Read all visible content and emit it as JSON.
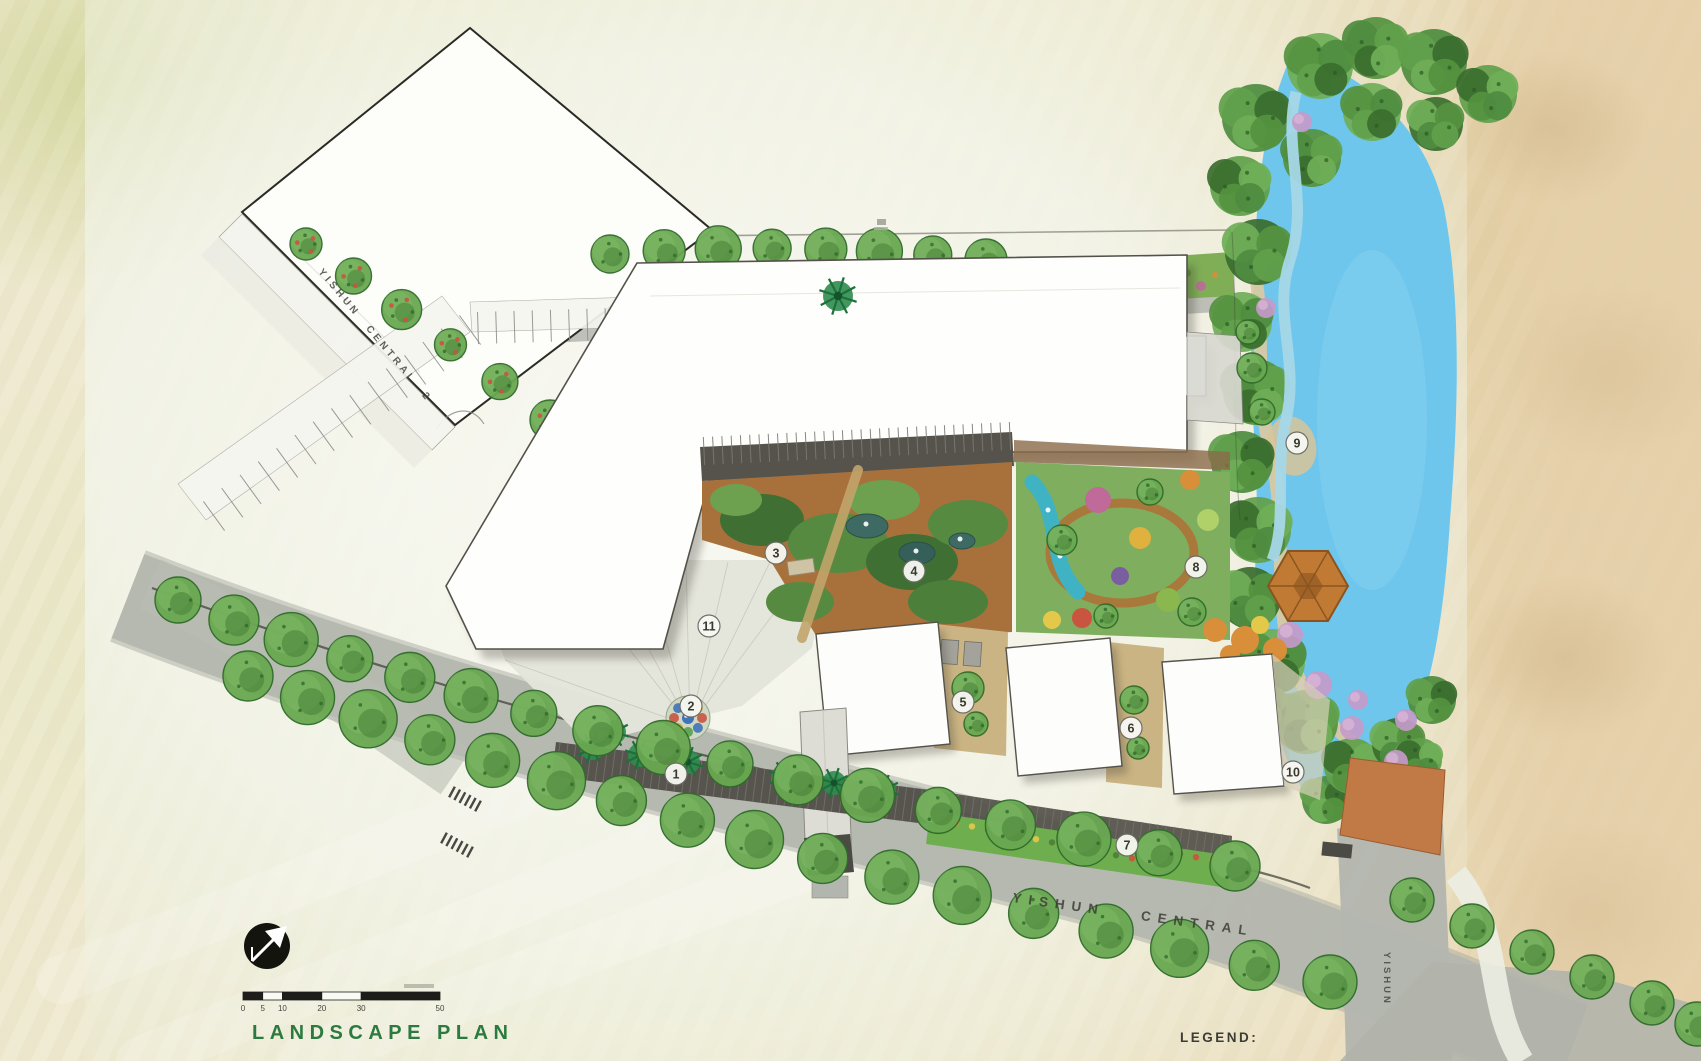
{
  "plan": {
    "title": "LANDSCAPE PLAN",
    "legend_label": "LEGEND:",
    "streets": [
      {
        "name": "YISHUN CENTRAL 2",
        "x": 318,
        "y": 272,
        "rotate": 50,
        "style": "st1"
      },
      {
        "name": "YISHUN CENTRAL",
        "x": 1012,
        "y": 902,
        "rotate": 8,
        "style": "st2"
      },
      {
        "name": "YISHUN",
        "x": 1384,
        "y": 952,
        "rotate": 90,
        "style": "st3"
      }
    ],
    "markers": [
      {
        "label": "1",
        "x": 676,
        "y": 774
      },
      {
        "label": "2",
        "x": 691,
        "y": 706
      },
      {
        "label": "3",
        "x": 776,
        "y": 553
      },
      {
        "label": "4",
        "x": 914,
        "y": 571
      },
      {
        "label": "5",
        "x": 963,
        "y": 702
      },
      {
        "label": "6",
        "x": 1131,
        "y": 728
      },
      {
        "label": "7",
        "x": 1127,
        "y": 845
      },
      {
        "label": "8",
        "x": 1196,
        "y": 567
      },
      {
        "label": "9",
        "x": 1297,
        "y": 443
      },
      {
        "label": "10",
        "x": 1293,
        "y": 772
      },
      {
        "label": "11",
        "x": 709,
        "y": 626
      }
    ],
    "scale_bar": {
      "unit_values": [
        "0",
        "5",
        "10",
        "20",
        "30",
        "50"
      ]
    },
    "icons": {
      "north_arrow": "north-arrow"
    },
    "colors": {
      "title_green": "#2c7a3f",
      "lake_blue": "#6ec6ec",
      "road_gray": "#b4b7af",
      "tree_green": "#69a851",
      "garden_brown": "#a8713c",
      "deck_terracotta": "#c17a45"
    }
  }
}
